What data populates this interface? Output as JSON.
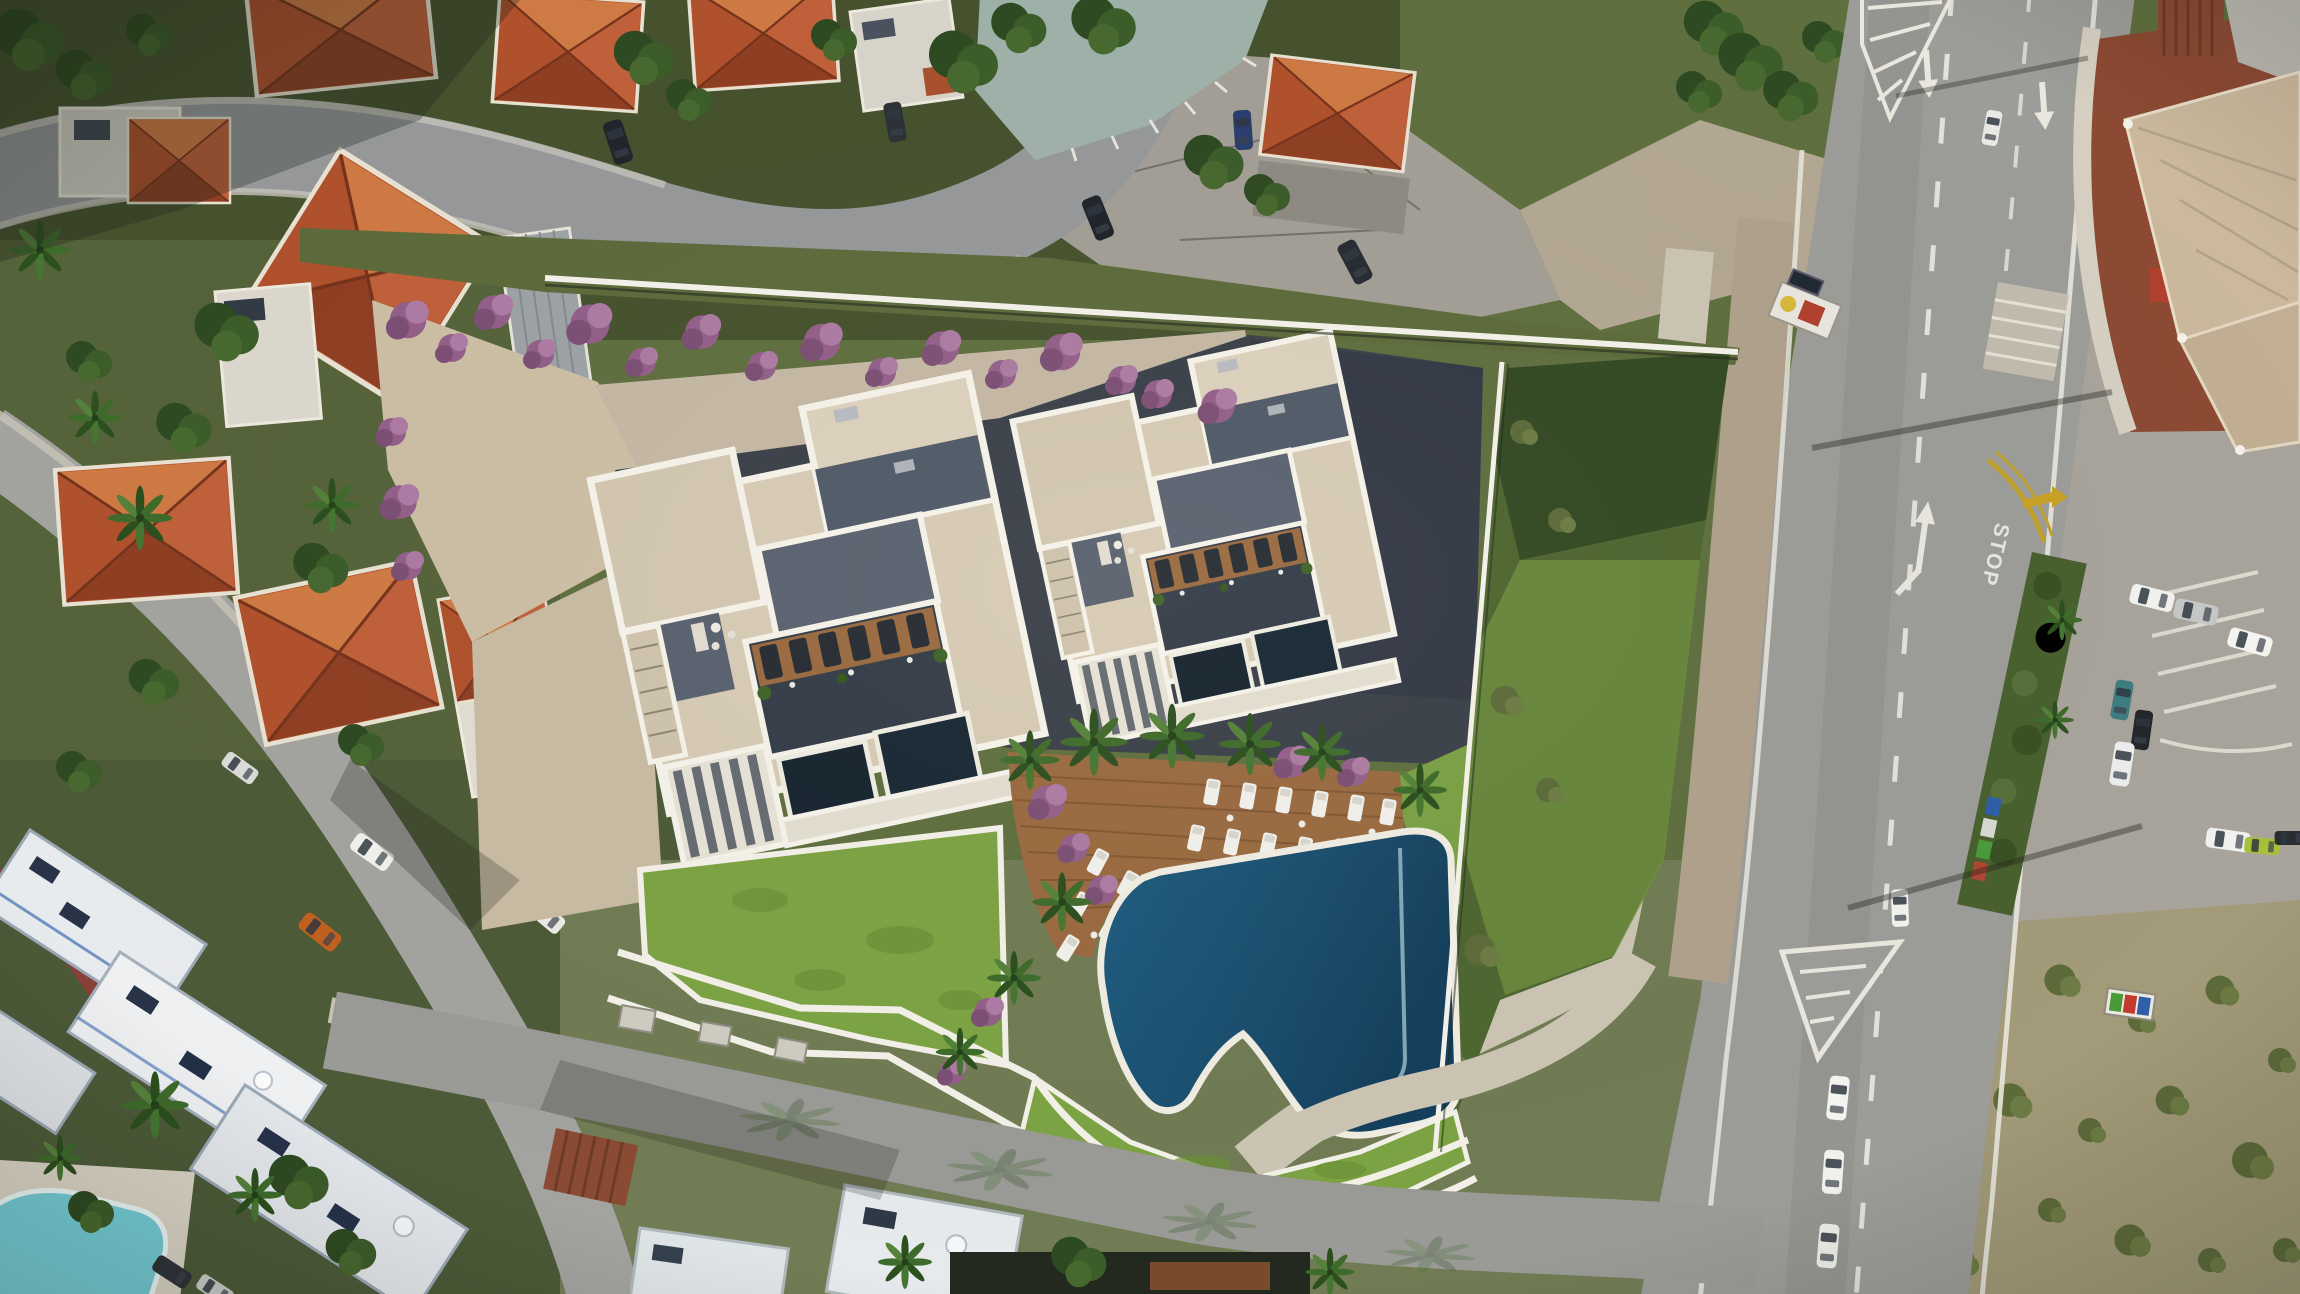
{
  "page": {
    "title": "Aerial drone view — seaside residential development with swimming pool"
  },
  "scene": {
    "type": "aerial-drone-photograph",
    "description": "Top-down drone photograph (development render composite) of two modern white apartment buildings with rooftop terraces and plunge pools, a freeform deep-blue swimming pool with timber sun deck, white loungers, lawns with white angular paths, palm trees and purple bougainvillea. The plot sits in a coastal neighborhood: terracotta-roofed villas above and left, a white hotel with a small cyan pool lower-left, a main asphalt road with lane markings, parking bays, recycling bins and a shade-sail restaurant terrace on the right.",
    "road_marking_stop": "STOP",
    "elements": {
      "development_buildings": "two white modern apartment blocks",
      "pool": "freeform deep-blue pool with white rim",
      "deck": "timber deck with two rows of white sun loungers",
      "landscape": "green lawns, white paths, palms, bougainvillea",
      "neighborhood": "terracotta hip-roofed villas and village streets",
      "hotel": "white flat-roofed hotel with cyan pool",
      "main_road": "two-lane asphalt road with white dashes and arrows",
      "parking": "parking area with cars and planted median with bins",
      "restaurant": "corner terrace under beige shade sails"
    },
    "palette": {
      "asphalt": "#9c9c98",
      "plot_shadow_asphalt": "#3a4049",
      "roof_terracotta": "#b0512c",
      "building_white": "#f6f3ea",
      "roof_beige": "#d7cbb5",
      "pool_deep_blue": "#1d5a7e",
      "hotel_pool_cyan": "#74cbd4",
      "lawn_green": "#7ca343",
      "deck_timber": "#9a6a40",
      "bougainvillea_purple": "#9a6590",
      "curb_yellow": "#c9a227"
    }
  }
}
